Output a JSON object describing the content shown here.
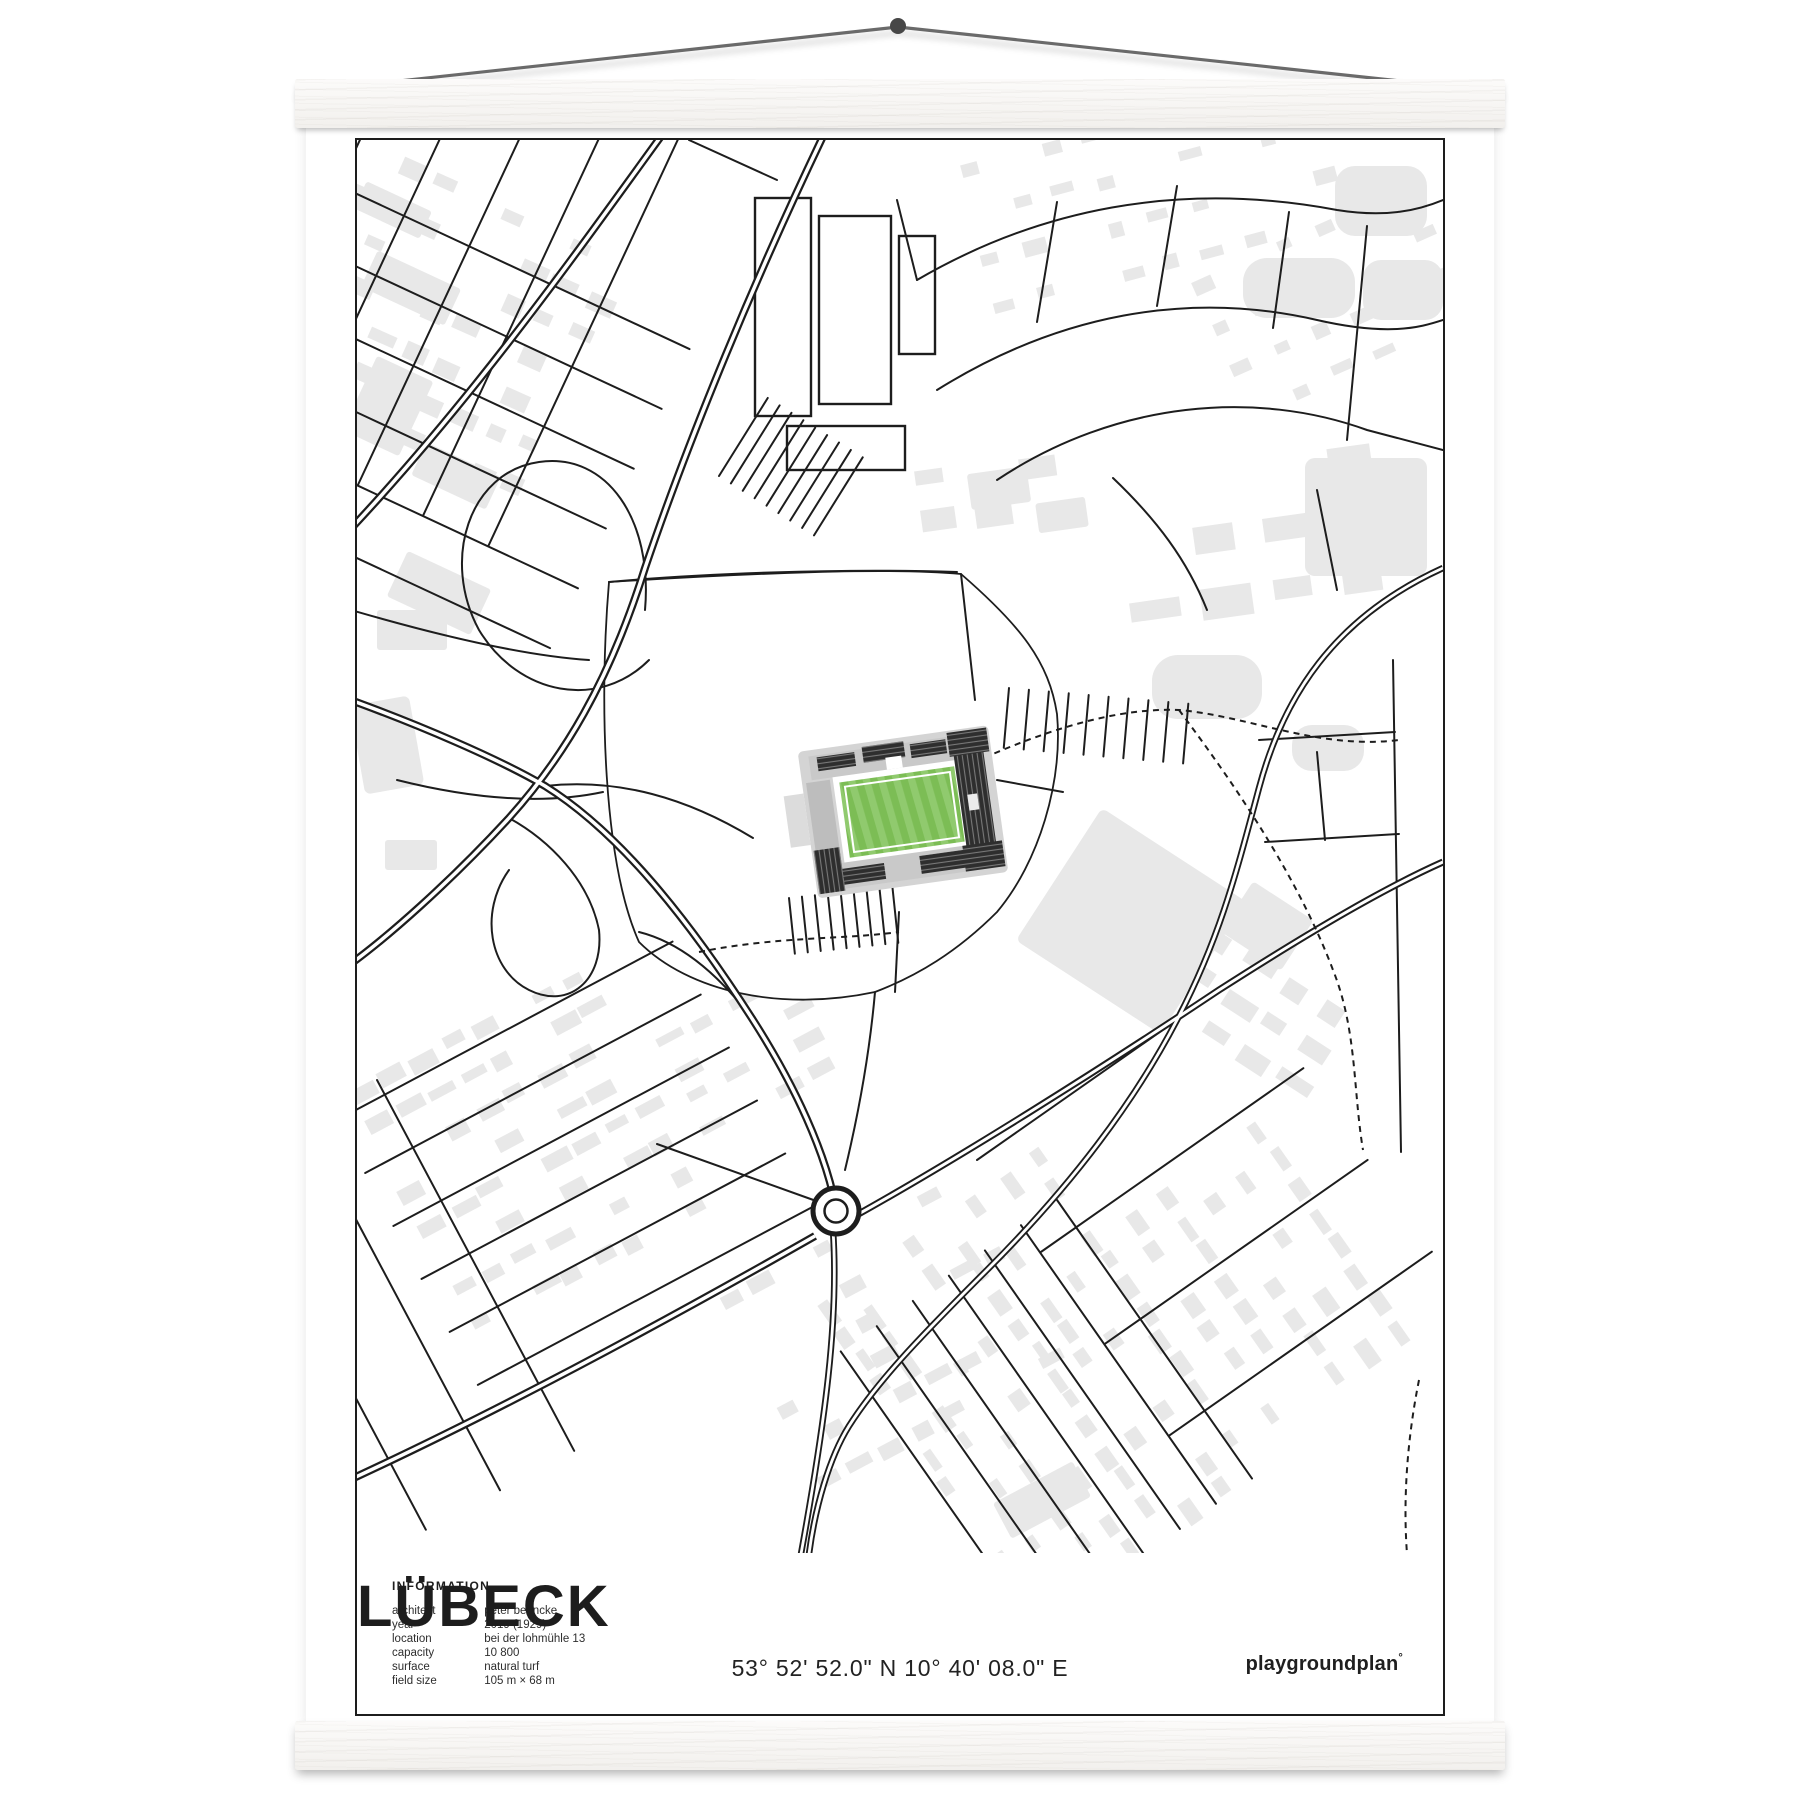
{
  "poster": {
    "title": "LÜBECK",
    "coordinates": "53° 52' 52.0\" N 10° 40' 08.0\" E",
    "brand_text": "playgroundplan",
    "brand_mark": "°",
    "information": {
      "heading": "INFORMATION",
      "rows": [
        {
          "label": "architect",
          "value": "peter behncke"
        },
        {
          "label": "year",
          "value": "2019 (1929)"
        },
        {
          "label": "location",
          "value": "bei der lohmühle 13"
        },
        {
          "label": "capacity",
          "value": "10 800"
        },
        {
          "label": "surface",
          "value": "natural turf"
        },
        {
          "label": "field size",
          "value": "105 m × 68 m"
        }
      ]
    }
  },
  "colors": {
    "pitch_green": "#7cbd55",
    "pitch_stripe": "#90ca6e",
    "building_gray": "#e8e8e8",
    "road_black": "#1d1d1d",
    "stand_dark": "#2e2e2e",
    "stand_light": "#c9c9c9",
    "plinth_gray": "#d4d4d4",
    "wood_white": "#f9f8f6",
    "cord_gray": "#6a6a6a",
    "text_black": "#1d1d1d",
    "paper_white": "#ffffff"
  }
}
